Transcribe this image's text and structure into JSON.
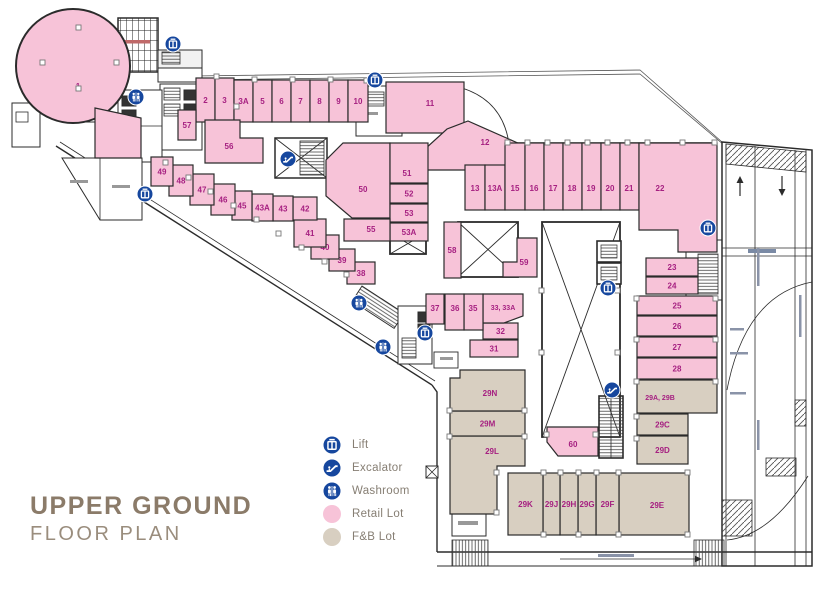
{
  "title": {
    "line1": "UPPER GROUND",
    "line2": "FLOOR PLAN"
  },
  "legend": [
    {
      "icon": "lift-icon",
      "type": "lift",
      "label": "Lift"
    },
    {
      "icon": "escalator-icon",
      "type": "escalator",
      "label": "Excalator"
    },
    {
      "icon": "washroom-icon",
      "type": "washroom",
      "label": "Washroom"
    },
    {
      "icon": "retail-swatch",
      "type": "retail",
      "label": "Retail Lot"
    },
    {
      "icon": "fnb-swatch",
      "type": "fnb",
      "label": "F&B Lot"
    }
  ],
  "colors": {
    "retail": "#f7c3d8",
    "fnb": "#d8cfc1",
    "lot_label": "#a62081",
    "icon_blue": "#16479e",
    "wall": "#2b2b2b",
    "title": "#8b7b69"
  },
  "plan": {
    "lots": [
      {
        "label": "1",
        "type": "retail",
        "shape": "circle",
        "c": [
          73,
          66,
          57
        ],
        "la": [
          78,
          86
        ]
      },
      {
        "label": "",
        "type": "retail",
        "shape": "poly",
        "p": [
          [
            95,
            108
          ],
          [
            141,
            118
          ],
          [
            141,
            158
          ],
          [
            95,
            158
          ]
        ]
      },
      {
        "label": "2",
        "type": "retail",
        "shape": "rect",
        "r": [
          196,
          78,
          19,
          44
        ]
      },
      {
        "label": "3",
        "type": "retail",
        "shape": "rect",
        "r": [
          215,
          78,
          19,
          44
        ]
      },
      {
        "label": "3A",
        "type": "retail",
        "shape": "rect",
        "r": [
          234,
          80,
          19,
          42
        ]
      },
      {
        "label": "5",
        "type": "retail",
        "shape": "rect",
        "r": [
          253,
          80,
          19,
          42
        ]
      },
      {
        "label": "6",
        "type": "retail",
        "shape": "rect",
        "r": [
          272,
          80,
          19,
          42
        ]
      },
      {
        "label": "7",
        "type": "retail",
        "shape": "rect",
        "r": [
          291,
          80,
          19,
          42
        ]
      },
      {
        "label": "8",
        "type": "retail",
        "shape": "rect",
        "r": [
          310,
          80,
          19,
          42
        ]
      },
      {
        "label": "9",
        "type": "retail",
        "shape": "rect",
        "r": [
          329,
          80,
          19,
          42
        ]
      },
      {
        "label": "10",
        "type": "retail",
        "shape": "rect",
        "r": [
          348,
          80,
          20,
          42
        ]
      },
      {
        "label": "11",
        "type": "retail",
        "shape": "rect",
        "r": [
          386,
          82,
          78,
          51
        ],
        "la": [
          430,
          103
        ]
      },
      {
        "label": "12",
        "type": "retail",
        "shape": "poly",
        "p": [
          [
            425,
            170
          ],
          [
            425,
            149
          ],
          [
            447,
            129
          ],
          [
            468,
            121
          ],
          [
            520,
            144
          ],
          [
            520,
            170
          ]
        ],
        "la": [
          485,
          142
        ]
      },
      {
        "label": "13",
        "type": "retail",
        "shape": "rect",
        "r": [
          465,
          165,
          20,
          45
        ],
        "la": [
          475,
          188
        ]
      },
      {
        "label": "13A",
        "type": "retail",
        "shape": "rect",
        "r": [
          485,
          165,
          20,
          45
        ],
        "la": [
          495,
          188
        ]
      },
      {
        "label": "15",
        "type": "retail",
        "shape": "rect",
        "r": [
          505,
          143,
          20,
          67
        ],
        "la": [
          515,
          188
        ]
      },
      {
        "label": "16",
        "type": "retail",
        "shape": "rect",
        "r": [
          525,
          143,
          19,
          67
        ],
        "la": [
          534,
          188
        ]
      },
      {
        "label": "17",
        "type": "retail",
        "shape": "rect",
        "r": [
          544,
          143,
          19,
          67
        ],
        "la": [
          553,
          188
        ]
      },
      {
        "label": "18",
        "type": "retail",
        "shape": "rect",
        "r": [
          563,
          143,
          19,
          67
        ],
        "la": [
          572,
          188
        ]
      },
      {
        "label": "19",
        "type": "retail",
        "shape": "rect",
        "r": [
          582,
          143,
          19,
          67
        ],
        "la": [
          591,
          188
        ]
      },
      {
        "label": "20",
        "type": "retail",
        "shape": "rect",
        "r": [
          601,
          143,
          19,
          67
        ],
        "la": [
          610,
          188
        ]
      },
      {
        "label": "21",
        "type": "retail",
        "shape": "rect",
        "r": [
          620,
          143,
          19,
          67
        ],
        "la": [
          629,
          188
        ]
      },
      {
        "label": "22",
        "type": "retail",
        "shape": "poly",
        "p": [
          [
            639,
            143
          ],
          [
            717,
            143
          ],
          [
            717,
            252
          ],
          [
            678,
            252
          ],
          [
            678,
            230
          ],
          [
            639,
            230
          ]
        ],
        "la": [
          660,
          188
        ]
      },
      {
        "label": "23",
        "type": "retail",
        "shape": "rect",
        "r": [
          646,
          258,
          52,
          18
        ]
      },
      {
        "label": "24",
        "type": "retail",
        "shape": "rect",
        "r": [
          646,
          277,
          52,
          17
        ]
      },
      {
        "label": "25",
        "type": "retail",
        "shape": "rect",
        "r": [
          637,
          296,
          80,
          19
        ]
      },
      {
        "label": "26",
        "type": "retail",
        "shape": "rect",
        "r": [
          637,
          316,
          80,
          20
        ]
      },
      {
        "label": "27",
        "type": "retail",
        "shape": "rect",
        "r": [
          637,
          337,
          80,
          20
        ]
      },
      {
        "label": "28",
        "type": "retail",
        "shape": "rect",
        "r": [
          637,
          358,
          80,
          21
        ]
      },
      {
        "label": "31",
        "type": "retail",
        "shape": "rect",
        "r": [
          470,
          340,
          48,
          17
        ]
      },
      {
        "label": "32",
        "type": "retail",
        "shape": "rect",
        "r": [
          483,
          323,
          35,
          16
        ]
      },
      {
        "label": "33, 33A",
        "type": "retail",
        "shape": "poly",
        "p": [
          [
            483,
            294
          ],
          [
            523,
            294
          ],
          [
            523,
            316
          ],
          [
            504,
            323
          ],
          [
            483,
            323
          ]
        ],
        "la": [
          503,
          307
        ],
        "small": true
      },
      {
        "label": "35",
        "type": "retail",
        "shape": "rect",
        "r": [
          464,
          294,
          19,
          36
        ],
        "la": [
          473,
          308
        ]
      },
      {
        "label": "36",
        "type": "retail",
        "shape": "rect",
        "r": [
          445,
          294,
          19,
          36
        ],
        "la": [
          455,
          308
        ]
      },
      {
        "label": "37",
        "type": "retail",
        "shape": "rect",
        "r": [
          426,
          294,
          18,
          30
        ],
        "la": [
          435,
          308
        ]
      },
      {
        "label": "38",
        "type": "retail",
        "shape": "rect",
        "r": [
          347,
          262,
          28,
          22
        ]
      },
      {
        "label": "39",
        "type": "retail",
        "shape": "rect",
        "r": [
          329,
          249,
          26,
          22
        ]
      },
      {
        "label": "40",
        "type": "retail",
        "shape": "rect",
        "r": [
          311,
          235,
          28,
          24
        ]
      },
      {
        "label": "41",
        "type": "retail",
        "shape": "rect",
        "r": [
          294,
          219,
          32,
          28
        ]
      },
      {
        "label": "42",
        "type": "retail",
        "shape": "rect",
        "r": [
          293,
          197,
          24,
          23
        ]
      },
      {
        "label": "43",
        "type": "retail",
        "shape": "rect",
        "r": [
          273,
          196,
          20,
          25
        ]
      },
      {
        "label": "43A",
        "type": "retail",
        "shape": "rect",
        "r": [
          252,
          194,
          21,
          27
        ]
      },
      {
        "label": "45",
        "type": "retail",
        "shape": "rect",
        "r": [
          232,
          191,
          20,
          29
        ]
      },
      {
        "label": "46",
        "type": "retail",
        "shape": "rect",
        "r": [
          211,
          184,
          24,
          31
        ]
      },
      {
        "label": "47",
        "type": "retail",
        "shape": "rect",
        "r": [
          190,
          174,
          24,
          31
        ]
      },
      {
        "label": "48",
        "type": "retail",
        "shape": "rect",
        "r": [
          169,
          165,
          24,
          31
        ]
      },
      {
        "label": "49",
        "type": "retail",
        "shape": "rect",
        "r": [
          151,
          157,
          22,
          29
        ]
      },
      {
        "label": "50",
        "type": "retail",
        "shape": "poly",
        "p": [
          [
            343,
            143
          ],
          [
            390,
            143
          ],
          [
            390,
            218
          ],
          [
            352,
            218
          ],
          [
            326,
            196
          ],
          [
            326,
            160
          ]
        ],
        "la": [
          363,
          189
        ]
      },
      {
        "label": "51",
        "type": "retail",
        "shape": "rect",
        "r": [
          390,
          143,
          38,
          40
        ],
        "la": [
          407,
          173
        ]
      },
      {
        "label": "52",
        "type": "retail",
        "shape": "rect",
        "r": [
          390,
          184,
          38,
          19
        ]
      },
      {
        "label": "53",
        "type": "retail",
        "shape": "rect",
        "r": [
          390,
          204,
          38,
          18
        ]
      },
      {
        "label": "53A",
        "type": "retail",
        "shape": "rect",
        "r": [
          390,
          223,
          38,
          18
        ]
      },
      {
        "label": "55",
        "type": "retail",
        "shape": "rect",
        "r": [
          344,
          219,
          46,
          22
        ],
        "la": [
          371,
          229
        ]
      },
      {
        "label": "56",
        "type": "retail",
        "shape": "poly",
        "p": [
          [
            205,
            120
          ],
          [
            240,
            120
          ],
          [
            240,
            138
          ],
          [
            263,
            138
          ],
          [
            263,
            163
          ],
          [
            205,
            163
          ]
        ],
        "la": [
          229,
          146
        ]
      },
      {
        "label": "57",
        "type": "retail",
        "shape": "rect",
        "r": [
          178,
          110,
          18,
          30
        ]
      },
      {
        "label": "58",
        "type": "retail",
        "shape": "rect",
        "r": [
          444,
          222,
          17,
          56
        ],
        "la": [
          452,
          250
        ]
      },
      {
        "label": "59",
        "type": "retail",
        "shape": "poly",
        "p": [
          [
            517,
            238
          ],
          [
            537,
            238
          ],
          [
            537,
            277
          ],
          [
            503,
            277
          ],
          [
            503,
            262
          ],
          [
            517,
            262
          ]
        ],
        "la": [
          524,
          262
        ]
      },
      {
        "label": "60",
        "type": "retail",
        "shape": "poly",
        "p": [
          [
            547,
            427
          ],
          [
            598,
            427
          ],
          [
            598,
            456
          ],
          [
            558,
            456
          ],
          [
            547,
            442
          ]
        ],
        "la": [
          573,
          444
        ]
      },
      {
        "label": "29A, 29B",
        "type": "fnb",
        "shape": "rect",
        "r": [
          637,
          380,
          80,
          33
        ],
        "la": [
          660,
          397
        ],
        "small": true
      },
      {
        "label": "29C",
        "type": "fnb",
        "shape": "rect",
        "r": [
          637,
          414,
          51,
          21
        ]
      },
      {
        "label": "29D",
        "type": "fnb",
        "shape": "rect",
        "r": [
          637,
          436,
          51,
          28
        ]
      },
      {
        "label": "29E",
        "type": "fnb",
        "shape": "rect",
        "r": [
          619,
          473,
          70,
          62
        ],
        "la": [
          657,
          505
        ]
      },
      {
        "label": "29F",
        "type": "fnb",
        "shape": "rect",
        "r": [
          596,
          473,
          23,
          62
        ]
      },
      {
        "label": "29G",
        "type": "fnb",
        "shape": "rect",
        "r": [
          578,
          473,
          18,
          62
        ]
      },
      {
        "label": "29H",
        "type": "fnb",
        "shape": "rect",
        "r": [
          560,
          473,
          18,
          62
        ]
      },
      {
        "label": "29J",
        "type": "fnb",
        "shape": "rect",
        "r": [
          543,
          473,
          17,
          62
        ]
      },
      {
        "label": "29K",
        "type": "fnb",
        "shape": "rect",
        "r": [
          508,
          473,
          35,
          62
        ]
      },
      {
        "label": "29L",
        "type": "fnb",
        "shape": "poly",
        "p": [
          [
            450,
            436
          ],
          [
            525,
            436
          ],
          [
            525,
            466
          ],
          [
            497,
            466
          ],
          [
            497,
            514
          ],
          [
            450,
            514
          ]
        ],
        "la": [
          492,
          451
        ]
      },
      {
        "label": "29M",
        "type": "fnb",
        "shape": "rect",
        "r": [
          450,
          411,
          75,
          25
        ]
      },
      {
        "label": "29N",
        "type": "fnb",
        "shape": "poly",
        "p": [
          [
            460,
            370
          ],
          [
            525,
            370
          ],
          [
            525,
            411
          ],
          [
            450,
            411
          ],
          [
            450,
            378
          ],
          [
            460,
            378
          ]
        ],
        "la": [
          490,
          393
        ]
      }
    ],
    "icons": [
      {
        "type": "lift",
        "x": 173,
        "y": 44
      },
      {
        "type": "lift",
        "x": 375,
        "y": 80
      },
      {
        "type": "lift",
        "x": 145,
        "y": 194
      },
      {
        "type": "lift",
        "x": 708,
        "y": 228
      },
      {
        "type": "lift",
        "x": 608,
        "y": 288
      },
      {
        "type": "lift",
        "x": 425,
        "y": 333
      },
      {
        "type": "washroom",
        "x": 136,
        "y": 97
      },
      {
        "type": "washroom",
        "x": 359,
        "y": 303
      },
      {
        "type": "washroom",
        "x": 383,
        "y": 347
      },
      {
        "type": "escalator",
        "x": 288,
        "y": 159
      },
      {
        "type": "escalator",
        "x": 612,
        "y": 390
      }
    ]
  }
}
